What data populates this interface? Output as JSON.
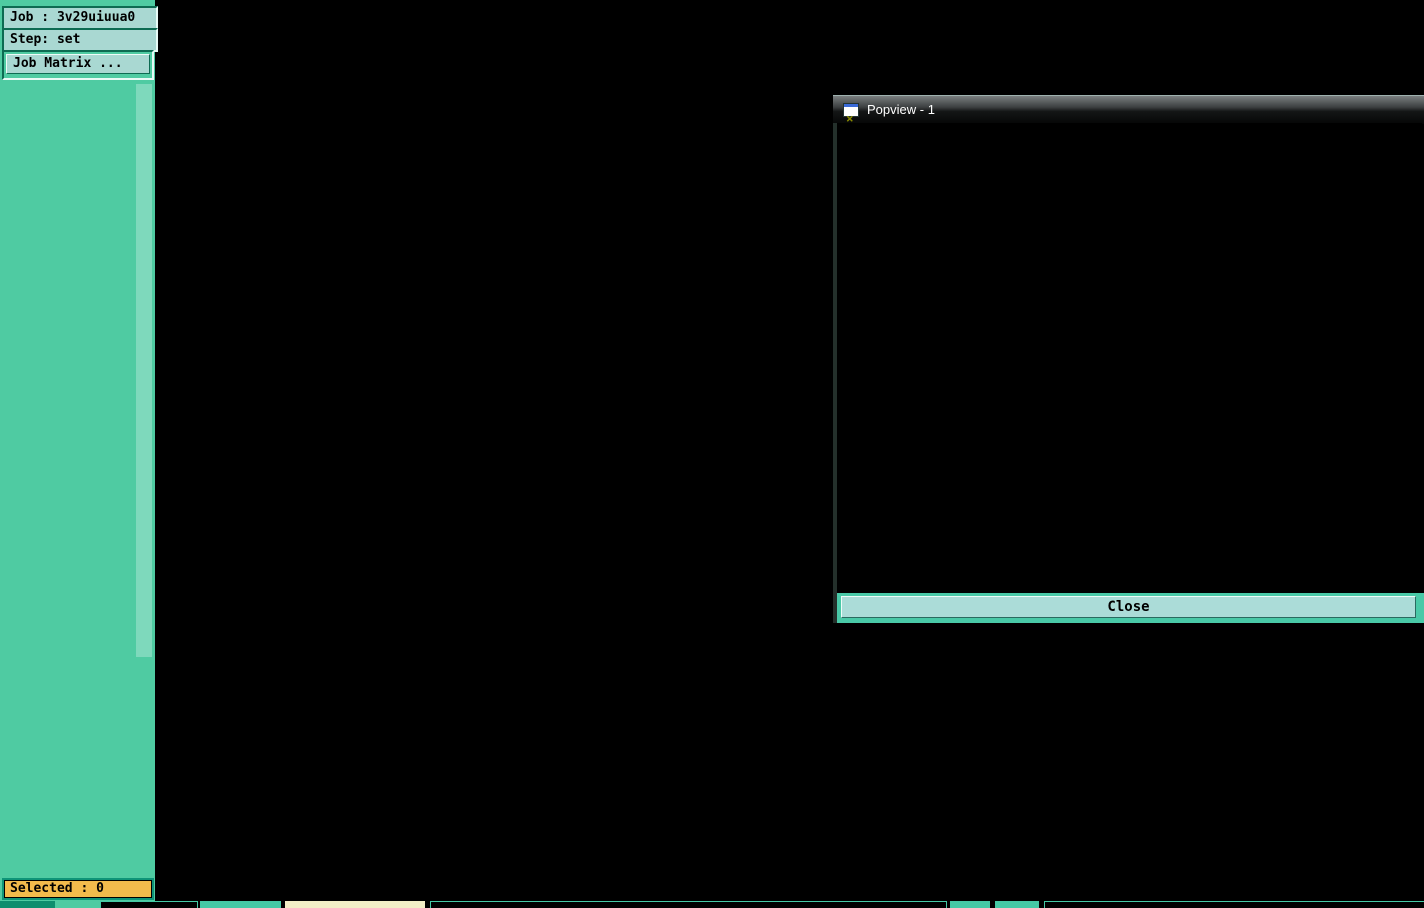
{
  "sidebar": {
    "job_label": "Job : 3v29uiuua0",
    "step_label": "Step: set",
    "job_matrix_label": "Job Matrix ...",
    "selected_label": "Selected : 0",
    "layer_groups": [
      {
        "rows": [
          {
            "label": "to",
            "bg": "#ffffff"
          },
          {
            "label": "ts1",
            "bg": "#0f9e74"
          },
          {
            "label": "ts",
            "bg": "#0f9e74"
          },
          {
            "label": "cs",
            "bg": "#f2bb4c"
          },
          {
            "label": "sig2b",
            "bg": "#f2bb4c"
          },
          {
            "label": "ss",
            "bg": "#f2bb4c"
          },
          {
            "label": "bs",
            "bg": "#0f9e74",
            "swatch": "#ee1010",
            "cb_highlight": "#2a35f0",
            "grid_icon": true
          },
          {
            "label": "bs1",
            "bg": "#0f9e74",
            "swatch": "#2f8a00"
          }
        ]
      },
      {
        "rows": [
          {
            "label": "drl",
            "bg": "#9badba",
            "swatch": "#1722f0"
          }
        ]
      },
      {
        "rows": [
          {
            "label": "cvia",
            "bg": "#aadee2"
          }
        ]
      },
      {
        "rows": [
          {
            "label": "rout",
            "bg": "#d6d6d6"
          }
        ]
      },
      {
        "rows": [
          {
            "label": "mill",
            "bg": "#aadee2"
          },
          {
            "label": "tp",
            "bg": "#aadee2"
          },
          {
            "label": "datecode-pt",
            "bg": "#aadee2"
          },
          {
            "label": "panel",
            "bg": "#aadee2"
          },
          {
            "label": "rou",
            "bg": "#aadee2"
          },
          {
            "label": "ydkdrl",
            "bg": "#aadee2"
          },
          {
            "label": "dwk",
            "bg": "#aadee2"
          },
          {
            "label": "dwkby",
            "bg": "#aadee2"
          },
          {
            "label": "gbfz3t",
            "bg": "#aadee2"
          },
          {
            "label": "fz1-2t",
            "bg": "#aadee2"
          },
          {
            "label": "fz3b",
            "bg": "#aadee2"
          },
          {
            "label": "biaozhu",
            "bg": "#aadee2"
          },
          {
            "label": "d",
            "bg": "#aadee2"
          },
          {
            "label": "ts.d",
            "bg": "#aadee2"
          },
          {
            "label": "cs.d",
            "bg": "#aadee2"
          },
          {
            "label": "sig2b.d",
            "bg": "#aadee2"
          },
          {
            "label": "ss.d",
            "bg": "#aadee2"
          },
          {
            "label": "bs.d",
            "bg": "#aadee2"
          },
          {
            "label": "drl.d",
            "bg": "#aadee2"
          },
          {
            "label": "rout.d",
            "bg": "#aadee2"
          },
          {
            "label": "mill.d",
            "bg": "#aadee2"
          },
          {
            "label": "panel.d",
            "bg": "#aadee2"
          },
          {
            "label": "rou.d",
            "bg": "#aadee2"
          }
        ]
      }
    ]
  },
  "popview": {
    "title": "Popview - 1",
    "close_label": "Close",
    "titlebar_icon": "window-x-icon"
  },
  "icons": {
    "bs_row_indicator": "grid-dots-icon",
    "layer_checkbox": "checkbox-unchecked"
  },
  "pcb_colors": {
    "copper": "#4a9b0f",
    "pad": "#b5940a",
    "drill": "#c6c0ef",
    "via": "#58c6f2",
    "via_blue": "#3b4cf2",
    "outline": "#b0a008",
    "outline_green": "#3f8c00",
    "red_line": "#d41d08",
    "marker": "#ffffff",
    "callout": "#ffffff",
    "callout_alt": "#cf9ed8",
    "sidebar_teal": "#4fcba2",
    "status_orange": "#f2bb4c"
  },
  "panel": {
    "board_rows": 2,
    "board_cols": 2
  }
}
